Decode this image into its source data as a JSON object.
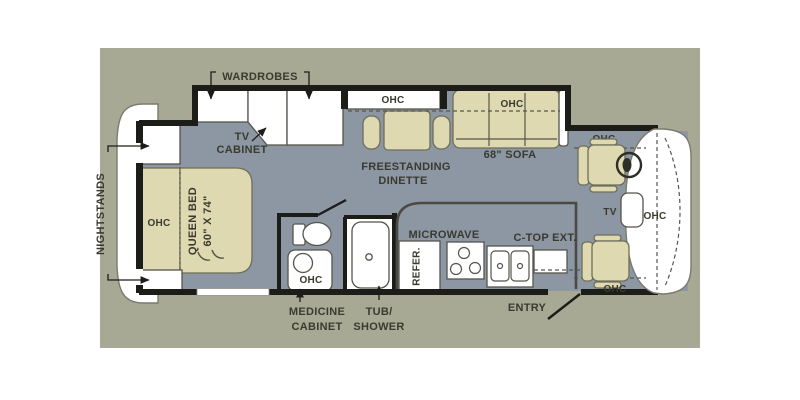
{
  "colors": {
    "panel": "#A8A994",
    "floor": "#8C97A3",
    "furniture": "#DFD9B2",
    "furniture_outline": "#6E6E58",
    "wall": "#1C1C18",
    "outline": "#55554C",
    "text": "#3A3A2F",
    "white": "#FFFFFF",
    "cap_outline": "#7A7A6E"
  },
  "labels": {
    "wardrobes": "WARDROBES",
    "tv_cabinet_line1": "TV",
    "tv_cabinet_line2": "CABINET",
    "nightstands": "NIGHTSTANDS",
    "queen_bed_line1": "QUEEN BED",
    "queen_bed_line2": "60\" X 74\"",
    "bedroom_ohc": "OHC",
    "dinette_ohc": "OHC",
    "dinette_line1": "FREESTANDING",
    "dinette_line2": "DINETTE",
    "sofa_ohc": "OHC",
    "sofa": "68\" SOFA",
    "vanity_ohc": "OHC",
    "medicine_line1": "MEDICINE",
    "medicine_line2": "CABINET",
    "tub_line1": "TUB/",
    "tub_line2": "SHOWER",
    "microwave": "MICROWAVE",
    "refrigerator": "REFER.",
    "ctop_ext": "C-TOP EXT.",
    "entry": "ENTRY",
    "cab_tv": "TV",
    "driver_ohc": "OHC",
    "front_ohc": "OHC",
    "passenger_ohc": "OHC"
  }
}
